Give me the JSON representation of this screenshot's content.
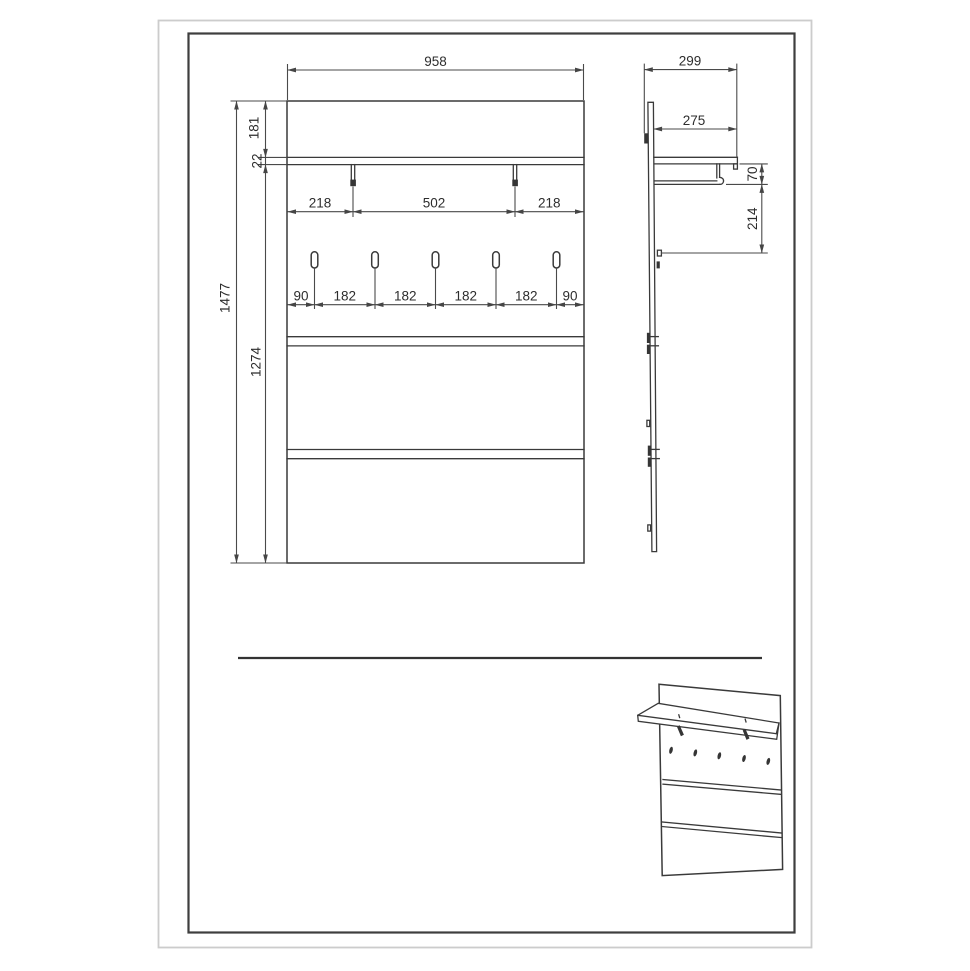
{
  "document": {
    "type": "furniture-dimension-drawing",
    "views": [
      "front-elevation",
      "side-section",
      "perspective-sketch"
    ]
  },
  "front_view": {
    "overall_width": "958",
    "top_offset": "181",
    "shelf_thickness": "22",
    "overall_height": "1477",
    "lower_height": "1274",
    "bracket_spacing": [
      "218",
      "502",
      "218"
    ],
    "hook_spacing": [
      "90",
      "182",
      "182",
      "182",
      "182",
      "90"
    ],
    "hook_count": 5
  },
  "side_view": {
    "overall_depth": "299",
    "shelf_depth": "275",
    "rail_drop": "70",
    "hook_drop": "214"
  },
  "colors": {
    "background": "#ffffff",
    "line": "#3a3a3a",
    "dimension_line": "#4a4a4a",
    "text": "#2d2d2d",
    "frame_outer": "#cccccc",
    "frame_inner": "#3e3e3e"
  }
}
